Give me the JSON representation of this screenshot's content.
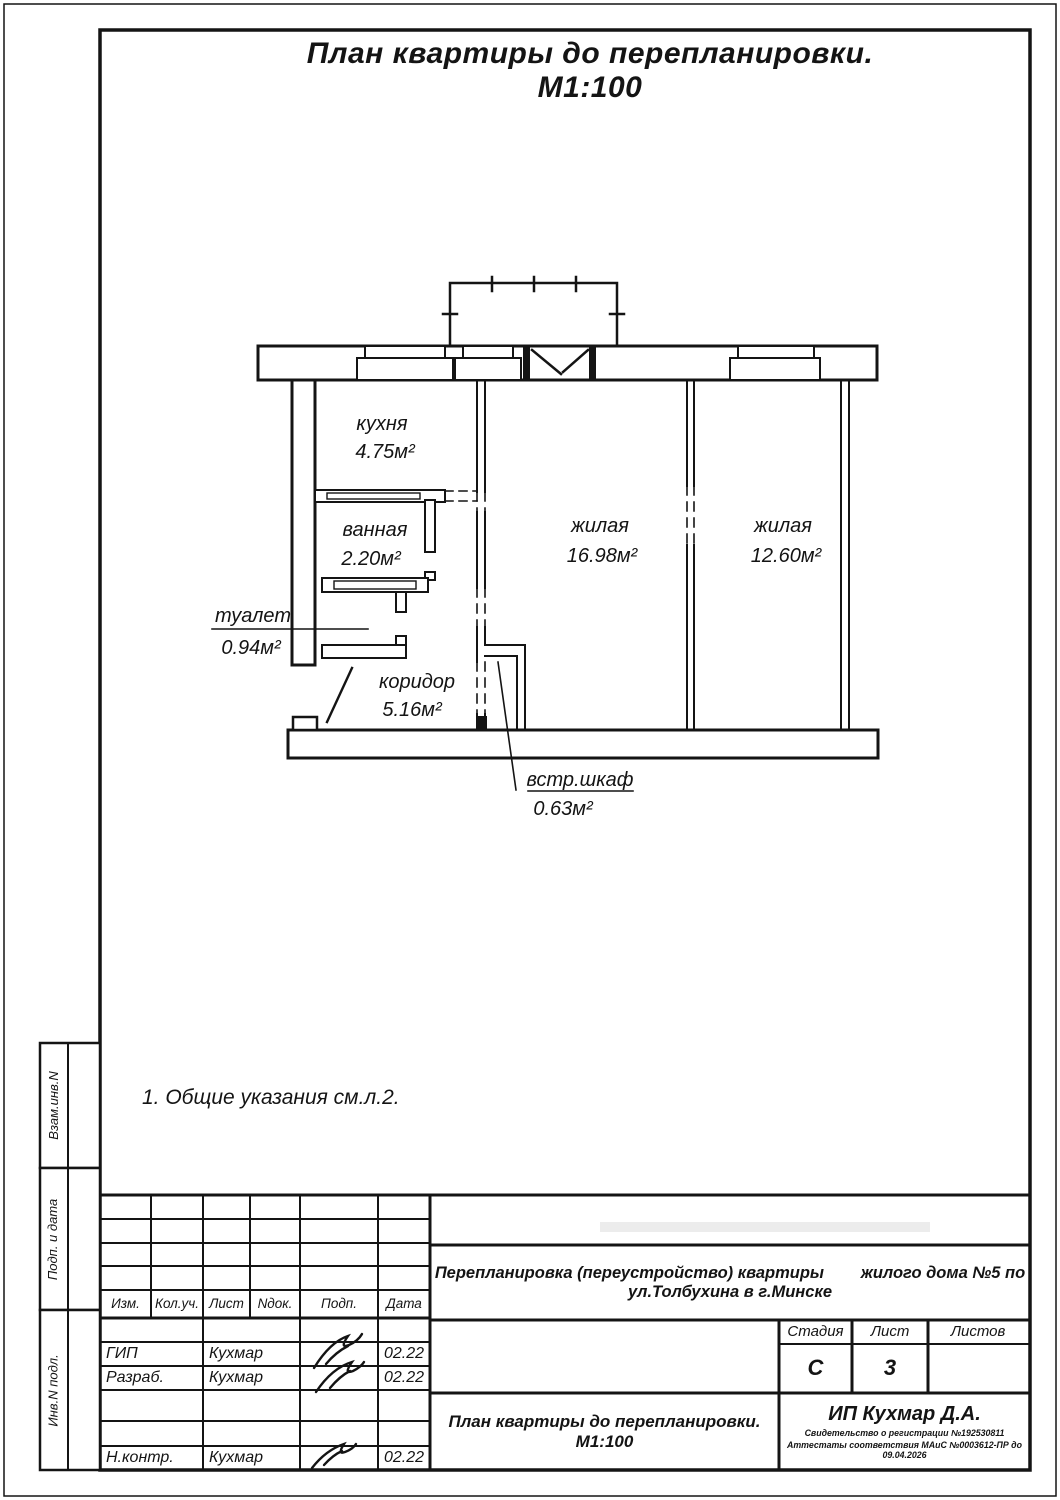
{
  "colors": {
    "ink": "#141414",
    "paper": "#ffffff"
  },
  "drawing_title": "План квартиры до перепланировки. М1:100",
  "note": "1. Общие указания см.л.2.",
  "plan": {
    "rooms": {
      "kitchen": {
        "name": "кухня",
        "area": "4.75м²"
      },
      "bathroom": {
        "name": "ванная",
        "area": "2.20м²"
      },
      "toilet": {
        "name": "туалет",
        "area": "0.94м²"
      },
      "corridor": {
        "name": "коридор",
        "area": "5.16м²"
      },
      "living1": {
        "name": "жилая",
        "area": "16.98м²"
      },
      "living2": {
        "name": "жилая",
        "area": "12.60м²"
      },
      "closet": {
        "name": "встр.шкаф",
        "area": "0.63м²"
      }
    }
  },
  "sidebar": {
    "items": [
      {
        "label": "Взам.инв.N"
      },
      {
        "label": "Подп. и дата"
      },
      {
        "label": "Инв.N подл."
      }
    ]
  },
  "titleblock": {
    "columns": {
      "izm": "Изм.",
      "kol": "Кол.уч.",
      "list": "Лист",
      "ndok": "Nдок.",
      "podp": "Подп.",
      "data": "Дата"
    },
    "rows": [
      {
        "role": "ГИП",
        "name": "Кухмар",
        "date": "02.22"
      },
      {
        "role": "Разраб.",
        "name": "Кухмар",
        "date": "02.22"
      },
      {
        "role": "Н.контр.",
        "name": "Кухмар",
        "date": "02.22"
      }
    ],
    "project_line1": "Перепланировка (переустройство) квартиры        жилого дома №5 по",
    "project_line2": "ул.Толбухина в г.Минске",
    "stage_label": "Стадия",
    "stage_value": "С",
    "sheet_label": "Лист",
    "sheet_value": "3",
    "sheets_label": "Листов",
    "sheets_value": "",
    "doc_line1": "План квартиры до перепланировки.",
    "doc_line2": "М1:100",
    "company_name": "ИП Кухмар Д.А.",
    "company_cert1": "Свидетельство о регистрации №192530811",
    "company_cert2": "Аттестаты соответствия МАиС №0003612-ПР до 09.04.2026"
  }
}
